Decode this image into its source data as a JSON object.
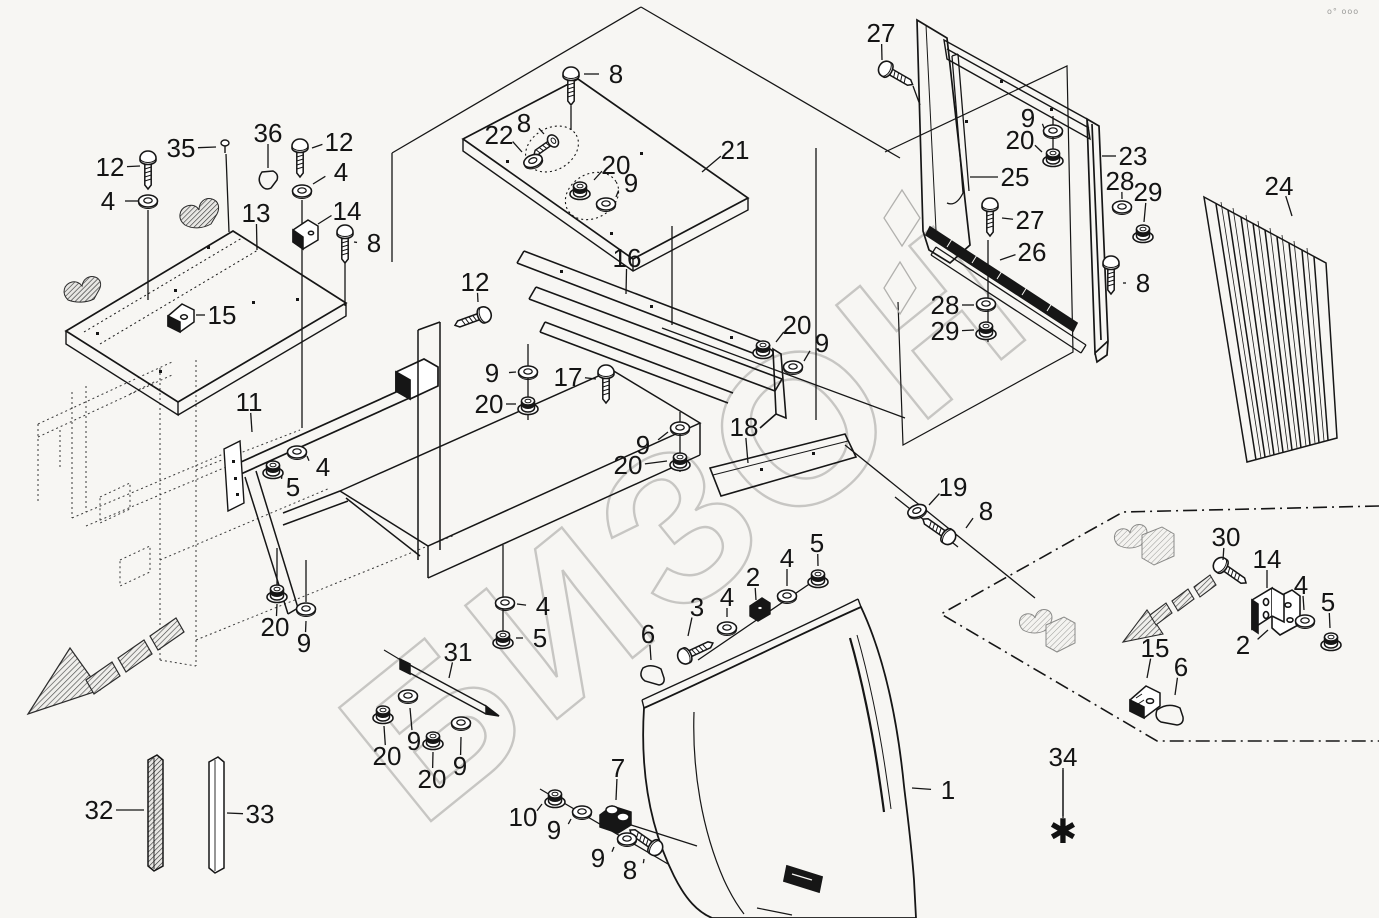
{
  "page": {
    "corner_text": "o° ooo",
    "background": "#f7f6f3"
  },
  "watermark": {
    "text": "БИЗОН",
    "color": "#c7c6c3"
  },
  "style": {
    "line": "#161616",
    "ghost": "#3a3a3a",
    "light_ghost": "#b2b1ae"
  },
  "asterisk": {
    "char": "✱",
    "x": 1063,
    "y": 843
  },
  "callouts": [
    {
      "l": "12",
      "x": 110,
      "y": 167,
      "tx": 140,
      "ty": 166
    },
    {
      "l": "4",
      "x": 108,
      "y": 201,
      "tx": 139,
      "ty": 201
    },
    {
      "l": "35",
      "x": 181,
      "y": 148,
      "tx": 216,
      "ty": 147
    },
    {
      "l": "36",
      "x": 268,
      "y": 133,
      "tx": 268,
      "ty": 168
    },
    {
      "l": "12",
      "x": 339,
      "y": 142,
      "tx": 312,
      "ty": 148
    },
    {
      "l": "4",
      "x": 341,
      "y": 172,
      "tx": 313,
      "ty": 184
    },
    {
      "l": "13",
      "x": 256,
      "y": 213,
      "tx": 257,
      "ty": 250
    },
    {
      "l": "14",
      "x": 347,
      "y": 211,
      "tx": 318,
      "ty": 224
    },
    {
      "l": "8",
      "x": 374,
      "y": 243,
      "tx": 354,
      "ty": 242
    },
    {
      "l": "15",
      "x": 222,
      "y": 315,
      "tx": 196,
      "ty": 315
    },
    {
      "l": "8",
      "x": 616,
      "y": 74,
      "tx": 584,
      "ty": 74
    },
    {
      "l": "22",
      "x": 499,
      "y": 135,
      "tx": 522,
      "ty": 152
    },
    {
      "l": "8",
      "x": 524,
      "y": 123,
      "tx": 544,
      "ty": 134
    },
    {
      "l": "20",
      "x": 616,
      "y": 165,
      "tx": 594,
      "ty": 180
    },
    {
      "l": "9",
      "x": 631,
      "y": 183,
      "tx": 616,
      "ty": 197
    },
    {
      "l": "21",
      "x": 735,
      "y": 150,
      "tx": 702,
      "ty": 172
    },
    {
      "l": "16",
      "x": 627,
      "y": 258,
      "tx": 626,
      "ty": 294
    },
    {
      "l": "12",
      "x": 475,
      "y": 282,
      "tx": 478,
      "ty": 302
    },
    {
      "l": "17",
      "x": 568,
      "y": 377,
      "tx": 596,
      "ty": 379
    },
    {
      "l": "9",
      "x": 492,
      "y": 373,
      "tx": 516,
      "ty": 372
    },
    {
      "l": "20",
      "x": 489,
      "y": 404,
      "tx": 516,
      "ty": 404
    },
    {
      "l": "9",
      "x": 643,
      "y": 445,
      "tx": 668,
      "ty": 432
    },
    {
      "l": "20",
      "x": 628,
      "y": 465,
      "tx": 667,
      "ty": 461
    },
    {
      "l": "18",
      "x": 744,
      "y": 427,
      "tx": 748,
      "ty": 463
    },
    {
      "l": "20",
      "x": 797,
      "y": 325,
      "tx": 776,
      "ty": 342
    },
    {
      "l": "9",
      "x": 822,
      "y": 343,
      "tx": 804,
      "ty": 361
    },
    {
      "l": "19",
      "x": 953,
      "y": 487,
      "tx": 929,
      "ty": 505
    },
    {
      "l": "8",
      "x": 986,
      "y": 511,
      "tx": 966,
      "ty": 528
    },
    {
      "l": "27",
      "x": 881,
      "y": 33,
      "tx": 882,
      "ty": 60
    },
    {
      "l": "9",
      "x": 1028,
      "y": 118,
      "tx": 1044,
      "ty": 128
    },
    {
      "l": "20",
      "x": 1020,
      "y": 140,
      "tx": 1042,
      "ty": 152
    },
    {
      "l": "23",
      "x": 1133,
      "y": 156,
      "tx": 1102,
      "ty": 156
    },
    {
      "l": "25",
      "x": 1015,
      "y": 177,
      "tx": 970,
      "ty": 177
    },
    {
      "l": "28",
      "x": 1120,
      "y": 181,
      "tx": 1122,
      "ty": 199
    },
    {
      "l": "29",
      "x": 1148,
      "y": 192,
      "tx": 1144,
      "ty": 222
    },
    {
      "l": "27",
      "x": 1030,
      "y": 220,
      "tx": 1002,
      "ty": 218
    },
    {
      "l": "26",
      "x": 1032,
      "y": 252,
      "tx": 1000,
      "ty": 260
    },
    {
      "l": "28",
      "x": 945,
      "y": 305,
      "tx": 974,
      "ty": 305
    },
    {
      "l": "29",
      "x": 945,
      "y": 331,
      "tx": 974,
      "ty": 330
    },
    {
      "l": "8",
      "x": 1143,
      "y": 283,
      "tx": 1123,
      "ty": 283
    },
    {
      "l": "24",
      "x": 1279,
      "y": 186,
      "tx": 1292,
      "ty": 216
    },
    {
      "l": "11",
      "x": 249,
      "y": 402,
      "tx": 252,
      "ty": 432
    },
    {
      "l": "4",
      "x": 323,
      "y": 467,
      "tx": 307,
      "ty": 456
    },
    {
      "l": "5",
      "x": 293,
      "y": 487,
      "tx": 282,
      "ty": 475
    },
    {
      "l": "20",
      "x": 275,
      "y": 627,
      "tx": 277,
      "ty": 604
    },
    {
      "l": "9",
      "x": 304,
      "y": 643,
      "tx": 306,
      "ty": 621
    },
    {
      "l": "4",
      "x": 543,
      "y": 606,
      "tx": 517,
      "ty": 604
    },
    {
      "l": "5",
      "x": 540,
      "y": 638,
      "tx": 516,
      "ty": 638
    },
    {
      "l": "31",
      "x": 458,
      "y": 652,
      "tx": 449,
      "ty": 678
    },
    {
      "l": "9",
      "x": 414,
      "y": 741,
      "tx": 410,
      "ty": 708
    },
    {
      "l": "20",
      "x": 387,
      "y": 756,
      "tx": 384,
      "ty": 726
    },
    {
      "l": "20",
      "x": 432,
      "y": 779,
      "tx": 433,
      "ty": 752
    },
    {
      "l": "9",
      "x": 460,
      "y": 766,
      "tx": 461,
      "ty": 737
    },
    {
      "l": "2",
      "x": 753,
      "y": 577,
      "tx": 756,
      "ty": 600
    },
    {
      "l": "3",
      "x": 697,
      "y": 607,
      "tx": 688,
      "ty": 636
    },
    {
      "l": "4",
      "x": 727,
      "y": 597,
      "tx": 727,
      "ty": 617
    },
    {
      "l": "4",
      "x": 787,
      "y": 558,
      "tx": 787,
      "ty": 586
    },
    {
      "l": "5",
      "x": 817,
      "y": 543,
      "tx": 818,
      "ty": 566
    },
    {
      "l": "6",
      "x": 648,
      "y": 634,
      "tx": 651,
      "ty": 660
    },
    {
      "l": "7",
      "x": 618,
      "y": 768,
      "tx": 616,
      "ty": 800
    },
    {
      "l": "10",
      "x": 523,
      "y": 817,
      "tx": 542,
      "ty": 804
    },
    {
      "l": "9",
      "x": 554,
      "y": 830,
      "tx": 571,
      "ty": 819
    },
    {
      "l": "9",
      "x": 598,
      "y": 858,
      "tx": 614,
      "ty": 847
    },
    {
      "l": "8",
      "x": 630,
      "y": 870,
      "tx": 644,
      "ty": 859
    },
    {
      "l": "1",
      "x": 948,
      "y": 790,
      "tx": 912,
      "ty": 788
    },
    {
      "l": "34",
      "x": 1063,
      "y": 757,
      "tx": 1063,
      "ty": 816
    },
    {
      "l": "32",
      "x": 99,
      "y": 810,
      "tx": 144,
      "ty": 810
    },
    {
      "l": "33",
      "x": 260,
      "y": 814,
      "tx": 227,
      "ty": 813
    },
    {
      "l": "30",
      "x": 1226,
      "y": 537,
      "tx": 1223,
      "ty": 560
    },
    {
      "l": "14",
      "x": 1267,
      "y": 559,
      "tx": 1267,
      "ty": 588
    },
    {
      "l": "4",
      "x": 1301,
      "y": 585,
      "tx": 1304,
      "ty": 610
    },
    {
      "l": "5",
      "x": 1328,
      "y": 602,
      "tx": 1330,
      "ty": 628
    },
    {
      "l": "2",
      "x": 1243,
      "y": 645,
      "tx": 1268,
      "ty": 630
    },
    {
      "l": "15",
      "x": 1155,
      "y": 648,
      "tx": 1147,
      "ty": 678
    },
    {
      "l": "6",
      "x": 1181,
      "y": 667,
      "tx": 1175,
      "ty": 695
    }
  ],
  "fasteners": [
    {
      "t": "bolt",
      "x": 571,
      "y": 72,
      "r": 0
    },
    {
      "t": "bolt",
      "x": 148,
      "y": 156,
      "r": 0
    },
    {
      "t": "bolt",
      "x": 300,
      "y": 144,
      "r": 0
    },
    {
      "t": "bolt",
      "x": 345,
      "y": 230,
      "r": 0
    },
    {
      "t": "bolt",
      "x": 884,
      "y": 68,
      "r": -60
    },
    {
      "t": "bolt",
      "x": 486,
      "y": 314,
      "r": 70
    },
    {
      "t": "bolt",
      "x": 606,
      "y": 370,
      "r": 0
    },
    {
      "t": "bolt",
      "x": 950,
      "y": 538,
      "r": 125
    },
    {
      "t": "bolt",
      "x": 990,
      "y": 203,
      "r": 0
    },
    {
      "t": "bolt",
      "x": 1111,
      "y": 261,
      "r": 0
    },
    {
      "t": "bolt",
      "x": 683,
      "y": 657,
      "r": -115
    },
    {
      "t": "bolt",
      "x": 657,
      "y": 849,
      "r": 125
    },
    {
      "t": "bolt",
      "x": 1219,
      "y": 564,
      "r": -55
    },
    {
      "t": "screw",
      "x": 553,
      "y": 141,
      "r": 55
    },
    {
      "t": "pin",
      "x": 225,
      "y": 143,
      "r": 0
    },
    {
      "t": "washer",
      "x": 148,
      "y": 201,
      "r": 0
    },
    {
      "t": "washer",
      "x": 302,
      "y": 191,
      "r": 0
    },
    {
      "t": "washer",
      "x": 533,
      "y": 161,
      "r": -20
    },
    {
      "t": "washer",
      "x": 606,
      "y": 204,
      "r": 0
    },
    {
      "t": "washer",
      "x": 528,
      "y": 372,
      "r": 0
    },
    {
      "t": "washer",
      "x": 680,
      "y": 428,
      "r": 0
    },
    {
      "t": "washer",
      "x": 793,
      "y": 367,
      "r": 0
    },
    {
      "t": "washer",
      "x": 917,
      "y": 511,
      "r": -20
    },
    {
      "t": "washer",
      "x": 1053,
      "y": 131,
      "r": 0
    },
    {
      "t": "washer",
      "x": 1122,
      "y": 207,
      "r": 0
    },
    {
      "t": "washer",
      "x": 986,
      "y": 304,
      "r": 0
    },
    {
      "t": "washer",
      "x": 297,
      "y": 452,
      "r": 0
    },
    {
      "t": "washer",
      "x": 306,
      "y": 609,
      "r": 0
    },
    {
      "t": "washer",
      "x": 505,
      "y": 603,
      "r": 0
    },
    {
      "t": "washer",
      "x": 408,
      "y": 696,
      "r": 0
    },
    {
      "t": "washer",
      "x": 461,
      "y": 723,
      "r": 0
    },
    {
      "t": "washer",
      "x": 727,
      "y": 628,
      "r": 0
    },
    {
      "t": "washer",
      "x": 787,
      "y": 596,
      "r": 0
    },
    {
      "t": "washer",
      "x": 582,
      "y": 812,
      "r": 0
    },
    {
      "t": "washer",
      "x": 627,
      "y": 839,
      "r": 0
    },
    {
      "t": "washer",
      "x": 1305,
      "y": 621,
      "r": 0
    },
    {
      "t": "nut",
      "x": 580,
      "y": 189,
      "r": 0
    },
    {
      "t": "nut",
      "x": 528,
      "y": 404,
      "r": 0
    },
    {
      "t": "nut",
      "x": 680,
      "y": 460,
      "r": 0
    },
    {
      "t": "nut",
      "x": 763,
      "y": 348,
      "r": 0
    },
    {
      "t": "nut",
      "x": 1053,
      "y": 156,
      "r": 0
    },
    {
      "t": "nut",
      "x": 1143,
      "y": 232,
      "r": 0
    },
    {
      "t": "nut",
      "x": 986,
      "y": 329,
      "r": 0
    },
    {
      "t": "nut",
      "x": 273,
      "y": 468,
      "r": 0
    },
    {
      "t": "nut",
      "x": 277,
      "y": 592,
      "r": 0
    },
    {
      "t": "nut",
      "x": 503,
      "y": 638,
      "r": 0
    },
    {
      "t": "nut",
      "x": 383,
      "y": 713,
      "r": 0
    },
    {
      "t": "nut",
      "x": 433,
      "y": 739,
      "r": 0
    },
    {
      "t": "nut",
      "x": 818,
      "y": 577,
      "r": 0
    },
    {
      "t": "nut",
      "x": 555,
      "y": 797,
      "r": 0
    },
    {
      "t": "nut",
      "x": 1331,
      "y": 640,
      "r": 0
    }
  ]
}
